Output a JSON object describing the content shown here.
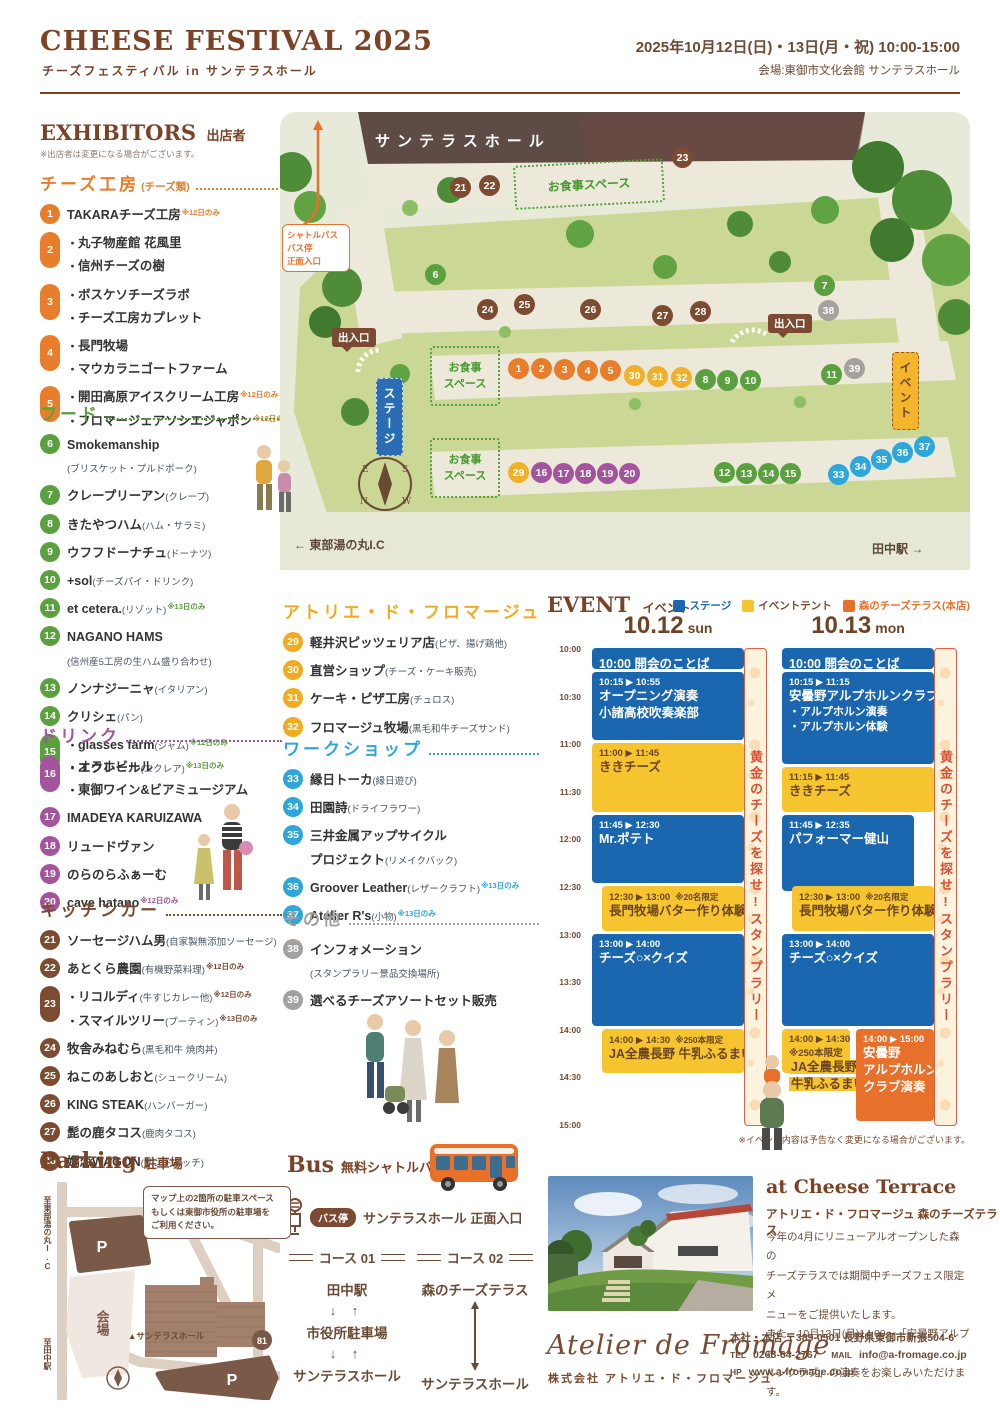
{
  "header": {
    "title": "CHEESE FESTIVAL 2025",
    "subtitle": "チーズフェスティバル in サンテラスホール",
    "date": "2025年10月12日(日)・13日(月・祝) 10:00-15:00",
    "venue": "会場:東御市文化会館 サンテラスホール"
  },
  "exhibitors": {
    "heading": "EXHIBITORS",
    "heading_jp": "出店者",
    "note": "※出店者は変更になる場合がございます。",
    "sections": [
      {
        "title": "チーズ工房",
        "paren": "(チーズ類)",
        "color": "#e87d2c",
        "items": [
          {
            "num": 1,
            "lines": [
              {
                "name": "TAKARAチーズ工房",
                "note": "※12日のみ"
              }
            ]
          },
          {
            "num": 2,
            "pill": true,
            "lines": [
              {
                "bullet": true,
                "name": "丸子物産館 花風里"
              },
              {
                "bullet": true,
                "name": "信州チーズの樹"
              }
            ]
          },
          {
            "num": 3,
            "pill": true,
            "lines": [
              {
                "bullet": true,
                "name": "ボスケソチーズラボ"
              },
              {
                "bullet": true,
                "name": "チーズ工房カプレット"
              }
            ]
          },
          {
            "num": 4,
            "pill": true,
            "lines": [
              {
                "bullet": true,
                "name": "長門牧場"
              },
              {
                "bullet": true,
                "name": "マウカラニゴートファーム"
              }
            ]
          },
          {
            "num": 5,
            "pill": true,
            "lines": [
              {
                "bullet": true,
                "name": "開田高原アイスクリーム工房",
                "note": "※12日のみ"
              },
              {
                "bullet": true,
                "name": "フロマージェアソシエジャポン",
                "note": "※12日のみ"
              }
            ]
          }
        ]
      },
      {
        "title": "フード",
        "paren": "",
        "color": "#5ba03e",
        "items": [
          {
            "num": 6,
            "lines": [
              {
                "name": "Smokemanship"
              },
              {
                "desc": "(ブリスケット・プルドポーク)"
              }
            ]
          },
          {
            "num": 7,
            "lines": [
              {
                "name": "クレープリーアン",
                "desc": "(クレープ)"
              }
            ]
          },
          {
            "num": 8,
            "lines": [
              {
                "name": "きたやつハム",
                "desc": "(ハム・サラミ)"
              }
            ]
          },
          {
            "num": 9,
            "lines": [
              {
                "name": "ウフフドーナチュ",
                "desc": "(ドーナツ)"
              }
            ]
          },
          {
            "num": 10,
            "lines": [
              {
                "name": "+sol",
                "desc": "(チーズパイ・ドリンク)"
              }
            ]
          },
          {
            "num": 11,
            "lines": [
              {
                "name": "et cetera.",
                "desc": "(リゾット)",
                "note": "※13日のみ"
              }
            ]
          },
          {
            "num": 12,
            "lines": [
              {
                "name": "NAGANO HAMS"
              },
              {
                "desc": "(信州産5工房の生ハム盛り合わせ)"
              }
            ]
          },
          {
            "num": 13,
            "lines": [
              {
                "name": "ノンナジーニャ",
                "desc": "(イタリアン)"
              }
            ]
          },
          {
            "num": 14,
            "lines": [
              {
                "name": "クリシェ",
                "desc": "(パン)"
              }
            ]
          },
          {
            "num": 15,
            "pill": true,
            "lines": [
              {
                "bullet": true,
                "name": "glasses farm",
                "desc": "(ジャム)",
                "note": "※12日のみ"
              },
              {
                "bullet": true,
                "name": "エクレール",
                "desc": "(エクレア)",
                "note": "※13日のみ"
              }
            ]
          }
        ]
      },
      {
        "title": "ドリンク",
        "paren": "",
        "color": "#a4539d",
        "items": [
          {
            "num": 16,
            "pill": true,
            "lines": [
              {
                "bullet": true,
                "name": "オラホビール"
              },
              {
                "bullet": true,
                "name": "東御ワイン&ビアミュージアム"
              }
            ]
          },
          {
            "num": 17,
            "lines": [
              {
                "name": "IMADEYA KARUIZAWA"
              }
            ]
          },
          {
            "num": 18,
            "lines": [
              {
                "name": "リュードヴァン"
              }
            ]
          },
          {
            "num": 19,
            "lines": [
              {
                "name": "のらのらふぁーむ"
              }
            ]
          },
          {
            "num": 20,
            "lines": [
              {
                "name": "cave hatano",
                "note": "※12日のみ"
              }
            ]
          }
        ]
      },
      {
        "title": "キッチンカー",
        "paren": "",
        "color": "#7c4b32",
        "items": [
          {
            "num": 21,
            "lines": [
              {
                "name": "ソーセージハム男",
                "desc": "(自家製無添加ソーセージ)"
              }
            ]
          },
          {
            "num": 22,
            "lines": [
              {
                "name": "あとくら農園",
                "desc": "(有機野菜料理)",
                "note": "※12日のみ"
              }
            ]
          },
          {
            "num": 23,
            "pill": true,
            "lines": [
              {
                "bullet": true,
                "name": "リコルディ",
                "desc": "(牛すじカレー他)",
                "note": "※12日のみ"
              },
              {
                "bullet": true,
                "name": "スマイルツリー",
                "desc": "(プーティン)",
                "note": "※13日のみ"
              }
            ]
          },
          {
            "num": 24,
            "lines": [
              {
                "name": "牧舎みねむら",
                "desc": "(黒毛和牛 焼肉丼)"
              }
            ]
          },
          {
            "num": 25,
            "lines": [
              {
                "name": "ねこのあしおと",
                "desc": "(シュークリーム)"
              }
            ]
          },
          {
            "num": 26,
            "lines": [
              {
                "name": "KING STEAK",
                "desc": "(ハンバーガー)"
              }
            ]
          },
          {
            "num": 27,
            "lines": [
              {
                "name": "髭の鹿タコス",
                "desc": "(鹿肉タコス)"
              }
            ]
          },
          {
            "num": 28,
            "lines": [
              {
                "name": "嬬恋WAGON",
                "desc": "(サンドイッチ)"
              }
            ]
          }
        ]
      },
      {
        "title": "アトリエ・ド・フロマージュ",
        "paren": "",
        "color": "#f0ac1e",
        "items": [
          {
            "num": 29,
            "lines": [
              {
                "name": "軽井沢ピッツェリア店",
                "desc": "(ピザ、揚げ鶏他)"
              }
            ]
          },
          {
            "num": 30,
            "lines": [
              {
                "name": "直営ショップ",
                "desc": "(チーズ・ケーキ販売)"
              }
            ]
          },
          {
            "num": 31,
            "lines": [
              {
                "name": "ケーキ・ピザ工房",
                "desc": "(チュロス)"
              }
            ]
          },
          {
            "num": 32,
            "lines": [
              {
                "name": "フロマージュ牧場",
                "desc": "(黒毛和牛チーズサンド)"
              }
            ]
          }
        ]
      },
      {
        "title": "ワークショップ",
        "paren": "",
        "color": "#2ea6da",
        "items": [
          {
            "num": 33,
            "lines": [
              {
                "name": "縁日トーカ",
                "desc": "(縁日遊び)"
              }
            ]
          },
          {
            "num": 34,
            "lines": [
              {
                "name": "田園詩",
                "desc": "(ドライフラワー)"
              }
            ]
          },
          {
            "num": 35,
            "lines": [
              {
                "name": "三井金属アップサイクル"
              },
              {
                "name": "プロジェクト",
                "desc": "(リメイクバック)"
              }
            ]
          },
          {
            "num": 36,
            "lines": [
              {
                "name": "Groover Leather",
                "desc": "(レザークラフト)",
                "note": "※13日のみ"
              }
            ]
          },
          {
            "num": 37,
            "lines": [
              {
                "name": "Atelier R's",
                "desc": "(小物)",
                "note": "※13日のみ"
              }
            ]
          }
        ]
      },
      {
        "title": "その他",
        "paren": "",
        "color": "#a3a09d",
        "items": [
          {
            "num": 38,
            "lines": [
              {
                "name": "インフォメーション"
              },
              {
                "desc": "(スタンプラリー景品交換場所)"
              }
            ]
          },
          {
            "num": 39,
            "lines": [
              {
                "name": "選べるチーズアソートセット販売"
              }
            ]
          }
        ]
      }
    ]
  },
  "map": {
    "hall_label": "サンテラスホール",
    "shuttle_lines": [
      "シャトルバス",
      "バス停",
      "正面入口"
    ],
    "gate_label": "出入口",
    "stage_label": "ステージ",
    "event_label": "イベント",
    "meal_label": "お食事スペース",
    "meal_lines": "お食事\nスペース",
    "ic_label": "← 東部湯の丸I.C",
    "station_label": "田中駅 →",
    "compass": [
      "E",
      "S",
      "N",
      "W"
    ],
    "colors": {
      "orange": "#e87d2c",
      "green": "#5ba03e",
      "purple": "#a4539d",
      "brown": "#7c4b32",
      "yellow": "#f0b02a",
      "blue": "#2ea6da",
      "gray": "#a3a09d"
    },
    "markers": [
      {
        "n": 21,
        "x": 180,
        "y": 75,
        "c": "brown"
      },
      {
        "n": 22,
        "x": 209,
        "y": 73,
        "c": "brown"
      },
      {
        "n": 23,
        "x": 402,
        "y": 45,
        "c": "brown"
      },
      {
        "n": 6,
        "x": 155,
        "y": 162,
        "c": "green"
      },
      {
        "n": 7,
        "x": 544,
        "y": 173,
        "c": "green"
      },
      {
        "n": 38,
        "x": 548,
        "y": 198,
        "c": "gray"
      },
      {
        "n": 24,
        "x": 207,
        "y": 197,
        "c": "brown"
      },
      {
        "n": 25,
        "x": 244,
        "y": 192,
        "c": "brown"
      },
      {
        "n": 26,
        "x": 310,
        "y": 197,
        "c": "brown"
      },
      {
        "n": 27,
        "x": 382,
        "y": 203,
        "c": "brown"
      },
      {
        "n": 28,
        "x": 420,
        "y": 199,
        "c": "brown"
      },
      {
        "n": 1,
        "x": 238,
        "y": 256,
        "c": "orange"
      },
      {
        "n": 2,
        "x": 261,
        "y": 256,
        "c": "orange"
      },
      {
        "n": 3,
        "x": 284,
        "y": 257,
        "c": "orange"
      },
      {
        "n": 4,
        "x": 307,
        "y": 258,
        "c": "orange"
      },
      {
        "n": 5,
        "x": 330,
        "y": 258,
        "c": "orange"
      },
      {
        "n": 30,
        "x": 354,
        "y": 263,
        "c": "yellow"
      },
      {
        "n": 31,
        "x": 377,
        "y": 264,
        "c": "yellow"
      },
      {
        "n": 32,
        "x": 401,
        "y": 265,
        "c": "yellow"
      },
      {
        "n": 8,
        "x": 425,
        "y": 267,
        "c": "green"
      },
      {
        "n": 9,
        "x": 447,
        "y": 268,
        "c": "green"
      },
      {
        "n": 10,
        "x": 470,
        "y": 268,
        "c": "green"
      },
      {
        "n": 11,
        "x": 551,
        "y": 262,
        "c": "green"
      },
      {
        "n": 39,
        "x": 574,
        "y": 256,
        "c": "gray"
      },
      {
        "n": 29,
        "x": 238,
        "y": 360,
        "c": "yellow"
      },
      {
        "n": 16,
        "x": 261,
        "y": 360,
        "c": "purple"
      },
      {
        "n": 17,
        "x": 283,
        "y": 361,
        "c": "purple"
      },
      {
        "n": 18,
        "x": 305,
        "y": 361,
        "c": "purple"
      },
      {
        "n": 19,
        "x": 327,
        "y": 361,
        "c": "purple"
      },
      {
        "n": 20,
        "x": 349,
        "y": 361,
        "c": "purple"
      },
      {
        "n": 12,
        "x": 444,
        "y": 360,
        "c": "green"
      },
      {
        "n": 13,
        "x": 466,
        "y": 361,
        "c": "green"
      },
      {
        "n": 14,
        "x": 488,
        "y": 361,
        "c": "green"
      },
      {
        "n": 15,
        "x": 510,
        "y": 361,
        "c": "green"
      },
      {
        "n": 33,
        "x": 558,
        "y": 362,
        "c": "blue"
      },
      {
        "n": 34,
        "x": 580,
        "y": 354,
        "c": "blue"
      },
      {
        "n": 35,
        "x": 601,
        "y": 347,
        "c": "blue"
      },
      {
        "n": 36,
        "x": 622,
        "y": 340,
        "c": "blue"
      },
      {
        "n": 37,
        "x": 644,
        "y": 334,
        "c": "blue"
      }
    ]
  },
  "event": {
    "heading": "EVENT",
    "heading_jp": "イベント",
    "legend": [
      {
        "label": "ステージ",
        "color": "#1a67b0",
        "text_color": "#1a67b0"
      },
      {
        "label": "イベントテント",
        "color": "#f5c42e",
        "text_color": "#7b4a2e"
      },
      {
        "label": "森のチーズテラス(本店)",
        "color": "#e7702b",
        "text_color": "#e7702b"
      }
    ],
    "time_labels": [
      "10:00",
      "10:30",
      "11:00",
      "11:30",
      "12:00",
      "12:30",
      "13:00",
      "13:30",
      "14:00",
      "14:30",
      "15:00"
    ],
    "stamp_rally": "黄金のチーズを探せ!スタンプラリー",
    "note": "※イベント内容は予告なく変更になる場合がございます。",
    "days": [
      {
        "label": "10.12",
        "sub": "sun",
        "events": [
          {
            "start": "10:00",
            "end": "10:15",
            "type": "stage",
            "inline": "10:00 開会のことば"
          },
          {
            "start": "10:15",
            "end": "11:00",
            "type": "stage",
            "time": "10:15 ▶ 10:55",
            "lines": [
              "オープニング演奏",
              "小諸高校吹奏楽部"
            ]
          },
          {
            "start": "11:00",
            "end": "11:45",
            "type": "tent",
            "time": "11:00 ▶ 11:45",
            "lines": [
              "ききチーズ"
            ]
          },
          {
            "start": "11:45",
            "end": "12:30",
            "type": "stage",
            "time": "11:45 ▶ 12:30",
            "lines": [
              "Mr.ポテト"
            ]
          },
          {
            "start": "12:30",
            "end": "13:00",
            "type": "tent",
            "indent": true,
            "time": "12:30 ▶ 13:00",
            "limit": "※20名限定",
            "lines": [
              "長門牧場バター作り体験"
            ]
          },
          {
            "start": "13:00",
            "end": "14:00",
            "type": "stage",
            "time": "13:00 ▶ 14:00",
            "lines": [
              "チーズ○×クイズ"
            ]
          },
          {
            "start": "14:00",
            "end": "14:30",
            "type": "tent",
            "indent": true,
            "time": "14:00 ▶ 14:30",
            "limit": "※250本限定",
            "lines": [
              "JA全農長野 牛乳ふるまい"
            ]
          }
        ]
      },
      {
        "label": "10.13",
        "sub": "mon",
        "events": [
          {
            "start": "10:00",
            "end": "10:15",
            "type": "stage",
            "inline": "10:00 開会のことば"
          },
          {
            "start": "10:15",
            "end": "11:15",
            "type": "stage",
            "time": "10:15 ▶ 11:15",
            "lines": [
              "安曇野アルプホルンクラブ",
              "・アルプホルン演奏",
              "・アルプホルン体験"
            ]
          },
          {
            "start": "11:15",
            "end": "11:45",
            "type": "tent",
            "time": "11:15 ▶ 11:45",
            "lines": [
              "ききチーズ"
            ]
          },
          {
            "start": "11:45",
            "end": "12:35",
            "type": "stage",
            "narrow": true,
            "time": "11:45 ▶ 12:35",
            "lines": [
              "パフォーマー健山"
            ]
          },
          {
            "start": "12:30",
            "end": "13:00",
            "type": "tent",
            "indent": true,
            "time": "12:30 ▶ 13:00",
            "limit": "※20名限定",
            "lines": [
              "長門牧場バター作り体験"
            ]
          },
          {
            "start": "13:00",
            "end": "14:00",
            "type": "stage",
            "time": "13:00 ▶ 14:00",
            "lines": [
              "チーズ○×クイズ"
            ]
          },
          {
            "start": "14:00",
            "end": "14:30",
            "type": "tent",
            "half": "left",
            "overflow": true,
            "hl": true,
            "time": "14:00 ▶ 14:30",
            "limit": "※250本限定",
            "lines": [
              "JA全農長野",
              "牛乳ふるまい"
            ]
          },
          {
            "start": "14:00",
            "end": "15:00",
            "type": "terrace",
            "half": "right",
            "time": "14:00 ▶ 15:00",
            "lines": [
              "安曇野",
              "アルプホルン",
              "クラブ演奏"
            ]
          }
        ]
      }
    ]
  },
  "parking": {
    "heading": "Parking",
    "heading_jp": "駐車場",
    "note_lines": [
      "マップ上の2箇所の駐車スペース",
      "もしくは東御市役所の駐車場を",
      "ご利用ください。"
    ],
    "to_ic": "至東部湯の丸I.C",
    "to_station": "至田中駅",
    "venue_label": "会場",
    "hall_label": "▲サンテラスホール",
    "route_badge": "81",
    "p_label": "P"
  },
  "bus": {
    "heading": "Bus",
    "heading_jp": "無料シャトルバス",
    "stop_badge": "バス停",
    "stop_text": "サンテラスホール 正面入口",
    "courses": [
      {
        "label": "コース 01",
        "stops": [
          "田中駅",
          "市役所駐車場",
          "サンテラスホール"
        ],
        "arrow": "pair"
      },
      {
        "label": "コース 02",
        "stops": [
          "森のチーズテラス",
          "サンテラスホール"
        ],
        "arrow": "long"
      }
    ]
  },
  "terrace": {
    "heading": "at Cheese Terrace",
    "subheading": "アトリエ・ド・フロマージュ 森のチーズテラス",
    "body": [
      "今年の4月にリニューアルオープンした森の",
      "チーズテラスでは期間中チーズフェス限定メ",
      "ニューをご提供いたします。",
      "また、10月13日(月)14:00〜「安曇野アルプホ",
      "ルンクラブ」の演奏をお楽しみいただけます。"
    ]
  },
  "footer": {
    "logo": "Atelier de Fromage",
    "company": "株式会社 アトリエ・ド・フロマージュ",
    "address": "本社・本店 〒389-0501 長野県東御市新張504-6",
    "tel_label": "TEL",
    "tel": "0268-64-2767",
    "mail_label": "MAIL",
    "mail": "info@a-fromage.co.jp",
    "hp_label": "HP",
    "hp": "www.a-fromage.co.jp"
  }
}
